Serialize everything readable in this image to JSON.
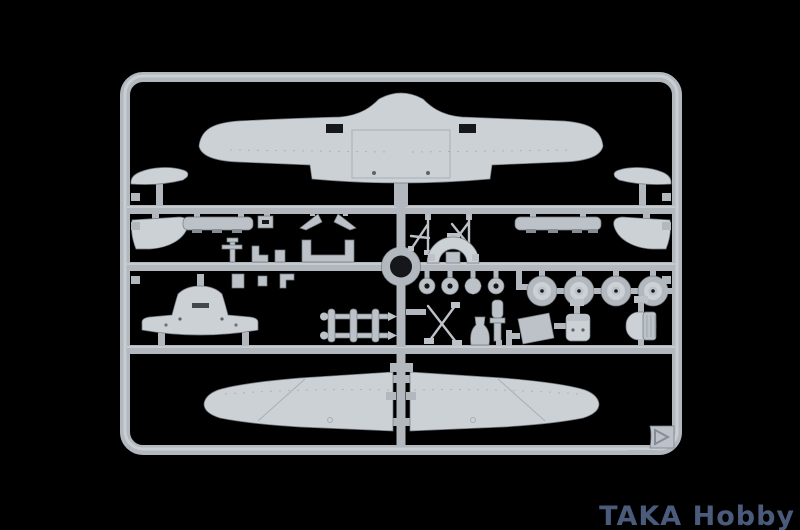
{
  "scene": {
    "description": "Light grey injection-moulded aircraft model kit sprue photographed on a black background"
  },
  "watermark": {
    "text": "TAKA Hobby"
  },
  "colors": {
    "background": "#000000",
    "plastic": "#b2b8be",
    "plastic-light": "#ccd1d6",
    "plastic-mid": "#bcc2c7",
    "plastic-dark": "#868d94",
    "plastic-edge": "#747b82",
    "hole": "#15171b",
    "watermark": "#4a5b7c"
  },
  "sprue": {
    "parts": [
      "one-piece-wing",
      "tailplane-half-left",
      "tailplane-half-right",
      "elevator-half-left",
      "elevator-half-right",
      "flap-strip-left",
      "flap-strip-right",
      "antenna-mast",
      "u-frame",
      "small-brackets",
      "cockpit-arch",
      "wire-struts",
      "bulkhead-dome",
      "hub-discs-x4",
      "main-wheels-x4",
      "exhaust-ladder",
      "gear-x-frame",
      "oleo-cylinder",
      "tailwheel-bell",
      "equipment-panel",
      "seat",
      "ribbed-drum",
      "lower-wing-half-left",
      "lower-wing-half-right",
      "corner-arrow-tab"
    ]
  }
}
